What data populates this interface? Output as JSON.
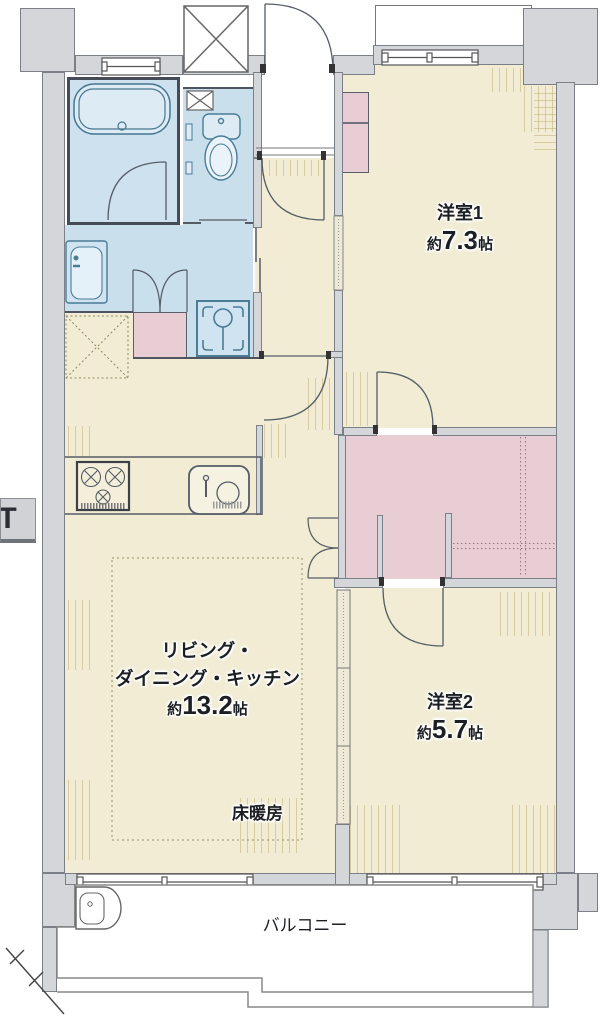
{
  "plan": {
    "type": "apartment-floor-plan",
    "rooms": [
      {
        "id": "western1",
        "name": "洋室1",
        "size_prefix": "約",
        "size_value": "7.3",
        "size_unit": "帖"
      },
      {
        "id": "western2",
        "name": "洋室2",
        "size_prefix": "約",
        "size_value": "5.7",
        "size_unit": "帖"
      },
      {
        "id": "ldk",
        "name_line1": "リビング・",
        "name_line2": "ダイニング・キッチン",
        "size_prefix": "約",
        "size_value": "13.2",
        "size_unit": "帖"
      }
    ],
    "labels": {
      "floor_heating": "床暖房",
      "balcony": "バルコニー",
      "edge_badge": "IT"
    },
    "colors": {
      "room_fill": "#f1ecd3",
      "water_fill": "#c9dfec",
      "closet_fill": "#e9cdd4",
      "wall_fill": "#d4d6d9",
      "line": "#555c66",
      "hatch": "#c0b176"
    },
    "fixtures": [
      "bathtub",
      "toilet",
      "vanity-basin",
      "washing-machine-pan",
      "refrigerator-space",
      "gas-stove",
      "kitchen-sink",
      "slop-sink",
      "pipe-space"
    ]
  }
}
